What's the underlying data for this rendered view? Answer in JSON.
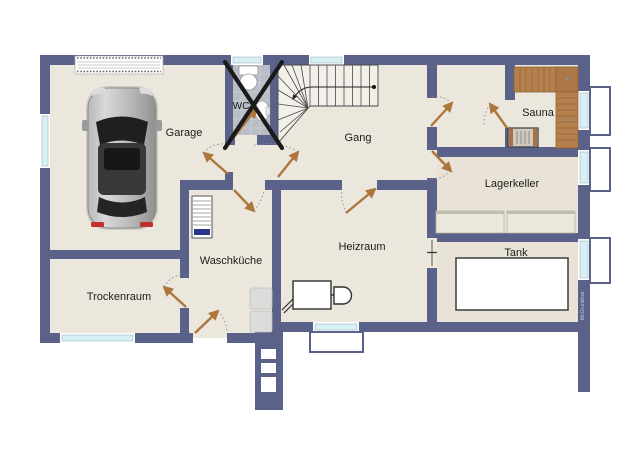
{
  "plan": {
    "rooms": [
      {
        "label": "Garage"
      },
      {
        "label": "WC"
      },
      {
        "label": "Gang"
      },
      {
        "label": "Sauna"
      },
      {
        "label": "Lagerkeller"
      },
      {
        "label": "Waschküche"
      },
      {
        "label": "Heizraum"
      },
      {
        "label": "Trockenraum"
      },
      {
        "label": "Tank"
      }
    ],
    "watermark": "McGrundriss",
    "colors": {
      "wall": "#5a628a",
      "floor": "#ebe7dd",
      "storage_floor": "#e8e3d6",
      "door_leaf": "#ad763c",
      "sauna_wood": "#b5804e",
      "window_glass": "#d7f0f6",
      "wc_tile": "#b8bdc6",
      "cross": "#1a1a1a"
    }
  }
}
